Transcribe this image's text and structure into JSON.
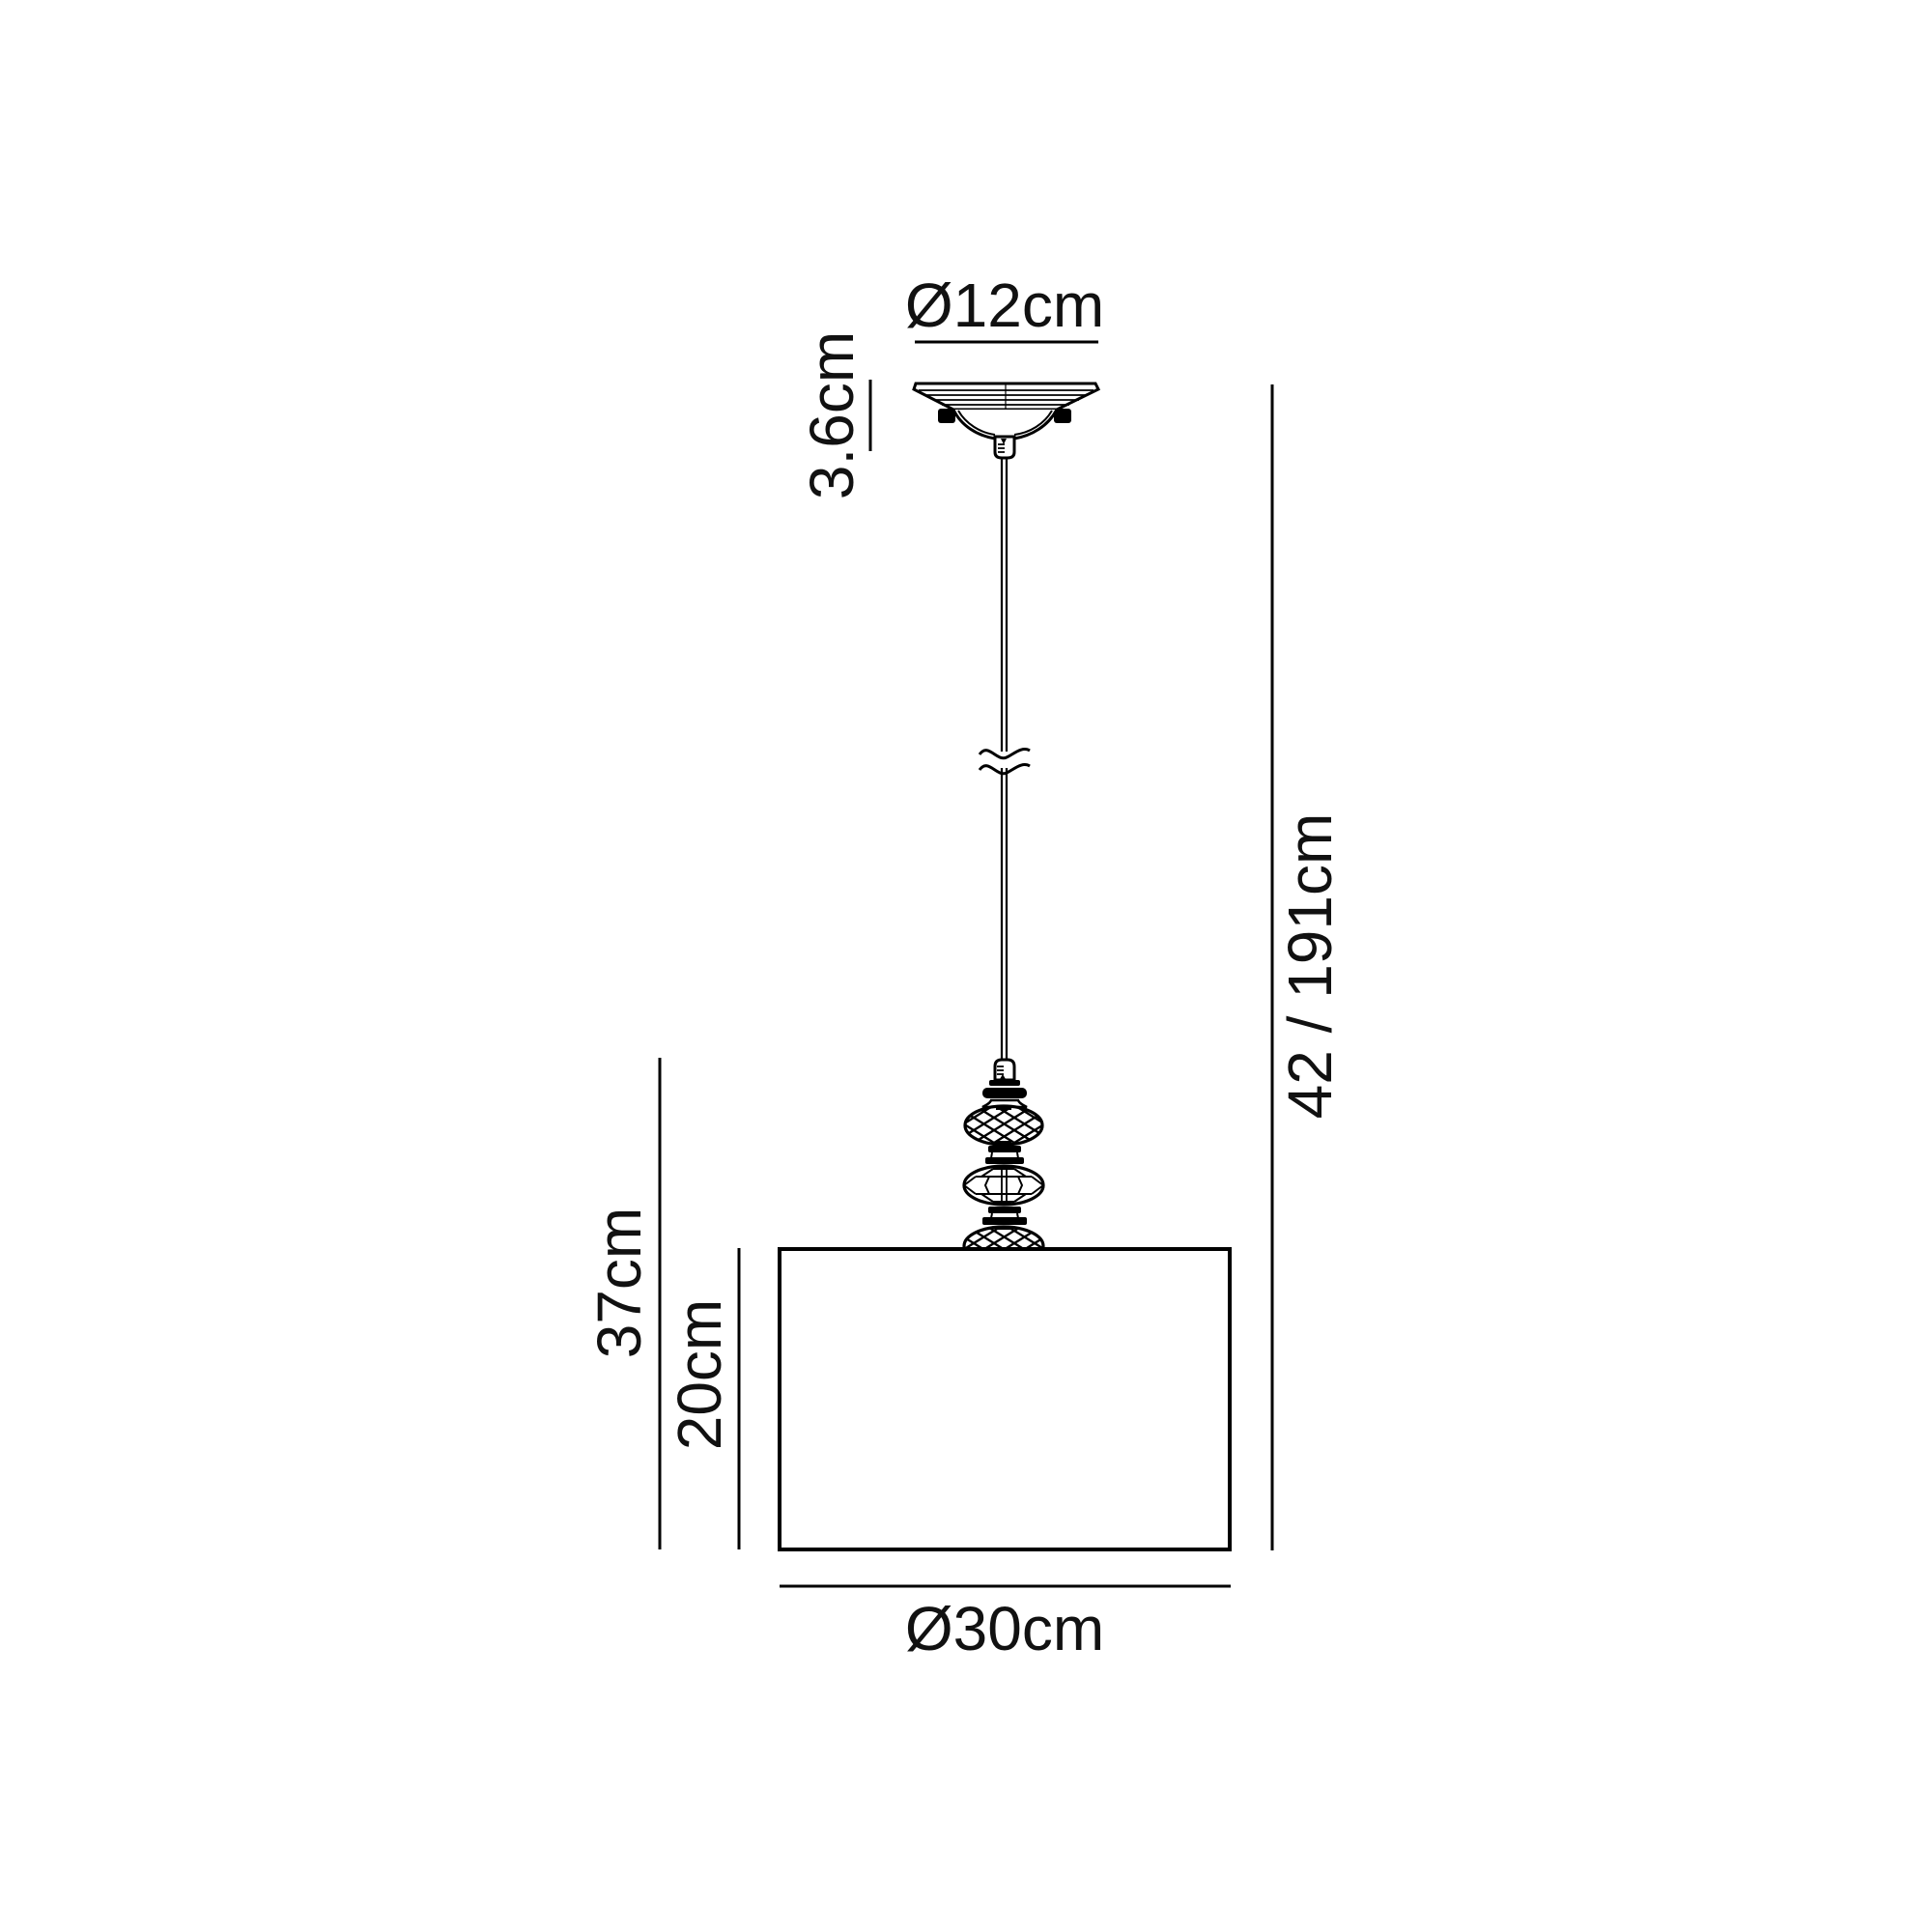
{
  "page": {
    "background": "#ffffff",
    "line_color": "#000000",
    "text_color": "#111111"
  },
  "labels": {
    "canopy_diameter": "Ø12cm",
    "canopy_height": "3.6cm",
    "drop_height": "42 / 191cm",
    "fixture_height": "37cm",
    "shade_height": "20cm",
    "shade_diameter": "Ø30cm"
  }
}
